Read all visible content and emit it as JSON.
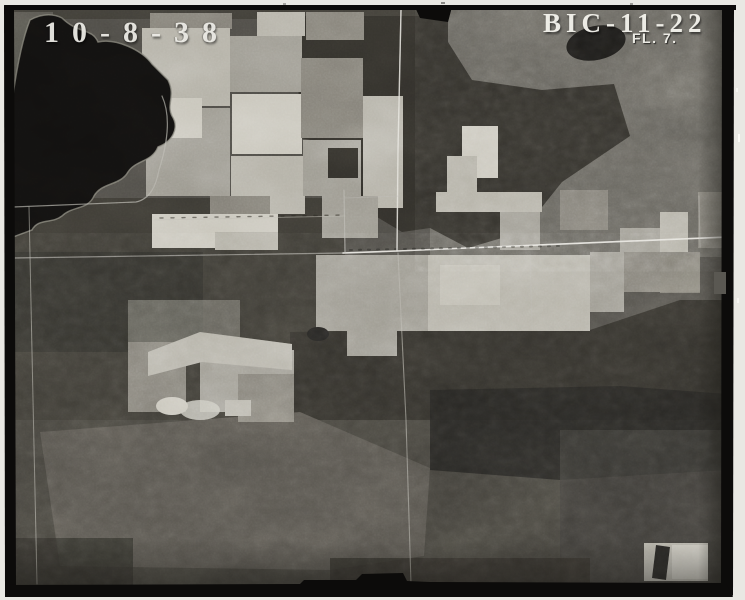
{
  "annotations": {
    "date_label": "10-8-38",
    "index_label": "BIC-11-22",
    "flight_label": "FL. 7."
  },
  "colors": {
    "paper": "#e9e8e3",
    "frame": "#0c0b0a",
    "photo_base": "#4b4944",
    "scrub_light": "#615f59",
    "forest_mid": "#3a3832",
    "forest_dark": "#302e29",
    "forest_deep": "#232220",
    "marsh": "#524f49",
    "bottom_ground": "#413f39",
    "lake_water": "#11100f",
    "shoreline": "#7e7c73",
    "field_bright": "#c7c4b9",
    "field_light": "#b1aea3",
    "field_mid": "#98958b",
    "field_dim": "#7c7971",
    "road_bright": "#e4e2db",
    "road_faint": "#b7b5ae",
    "label_white": "#f2f1eb"
  }
}
